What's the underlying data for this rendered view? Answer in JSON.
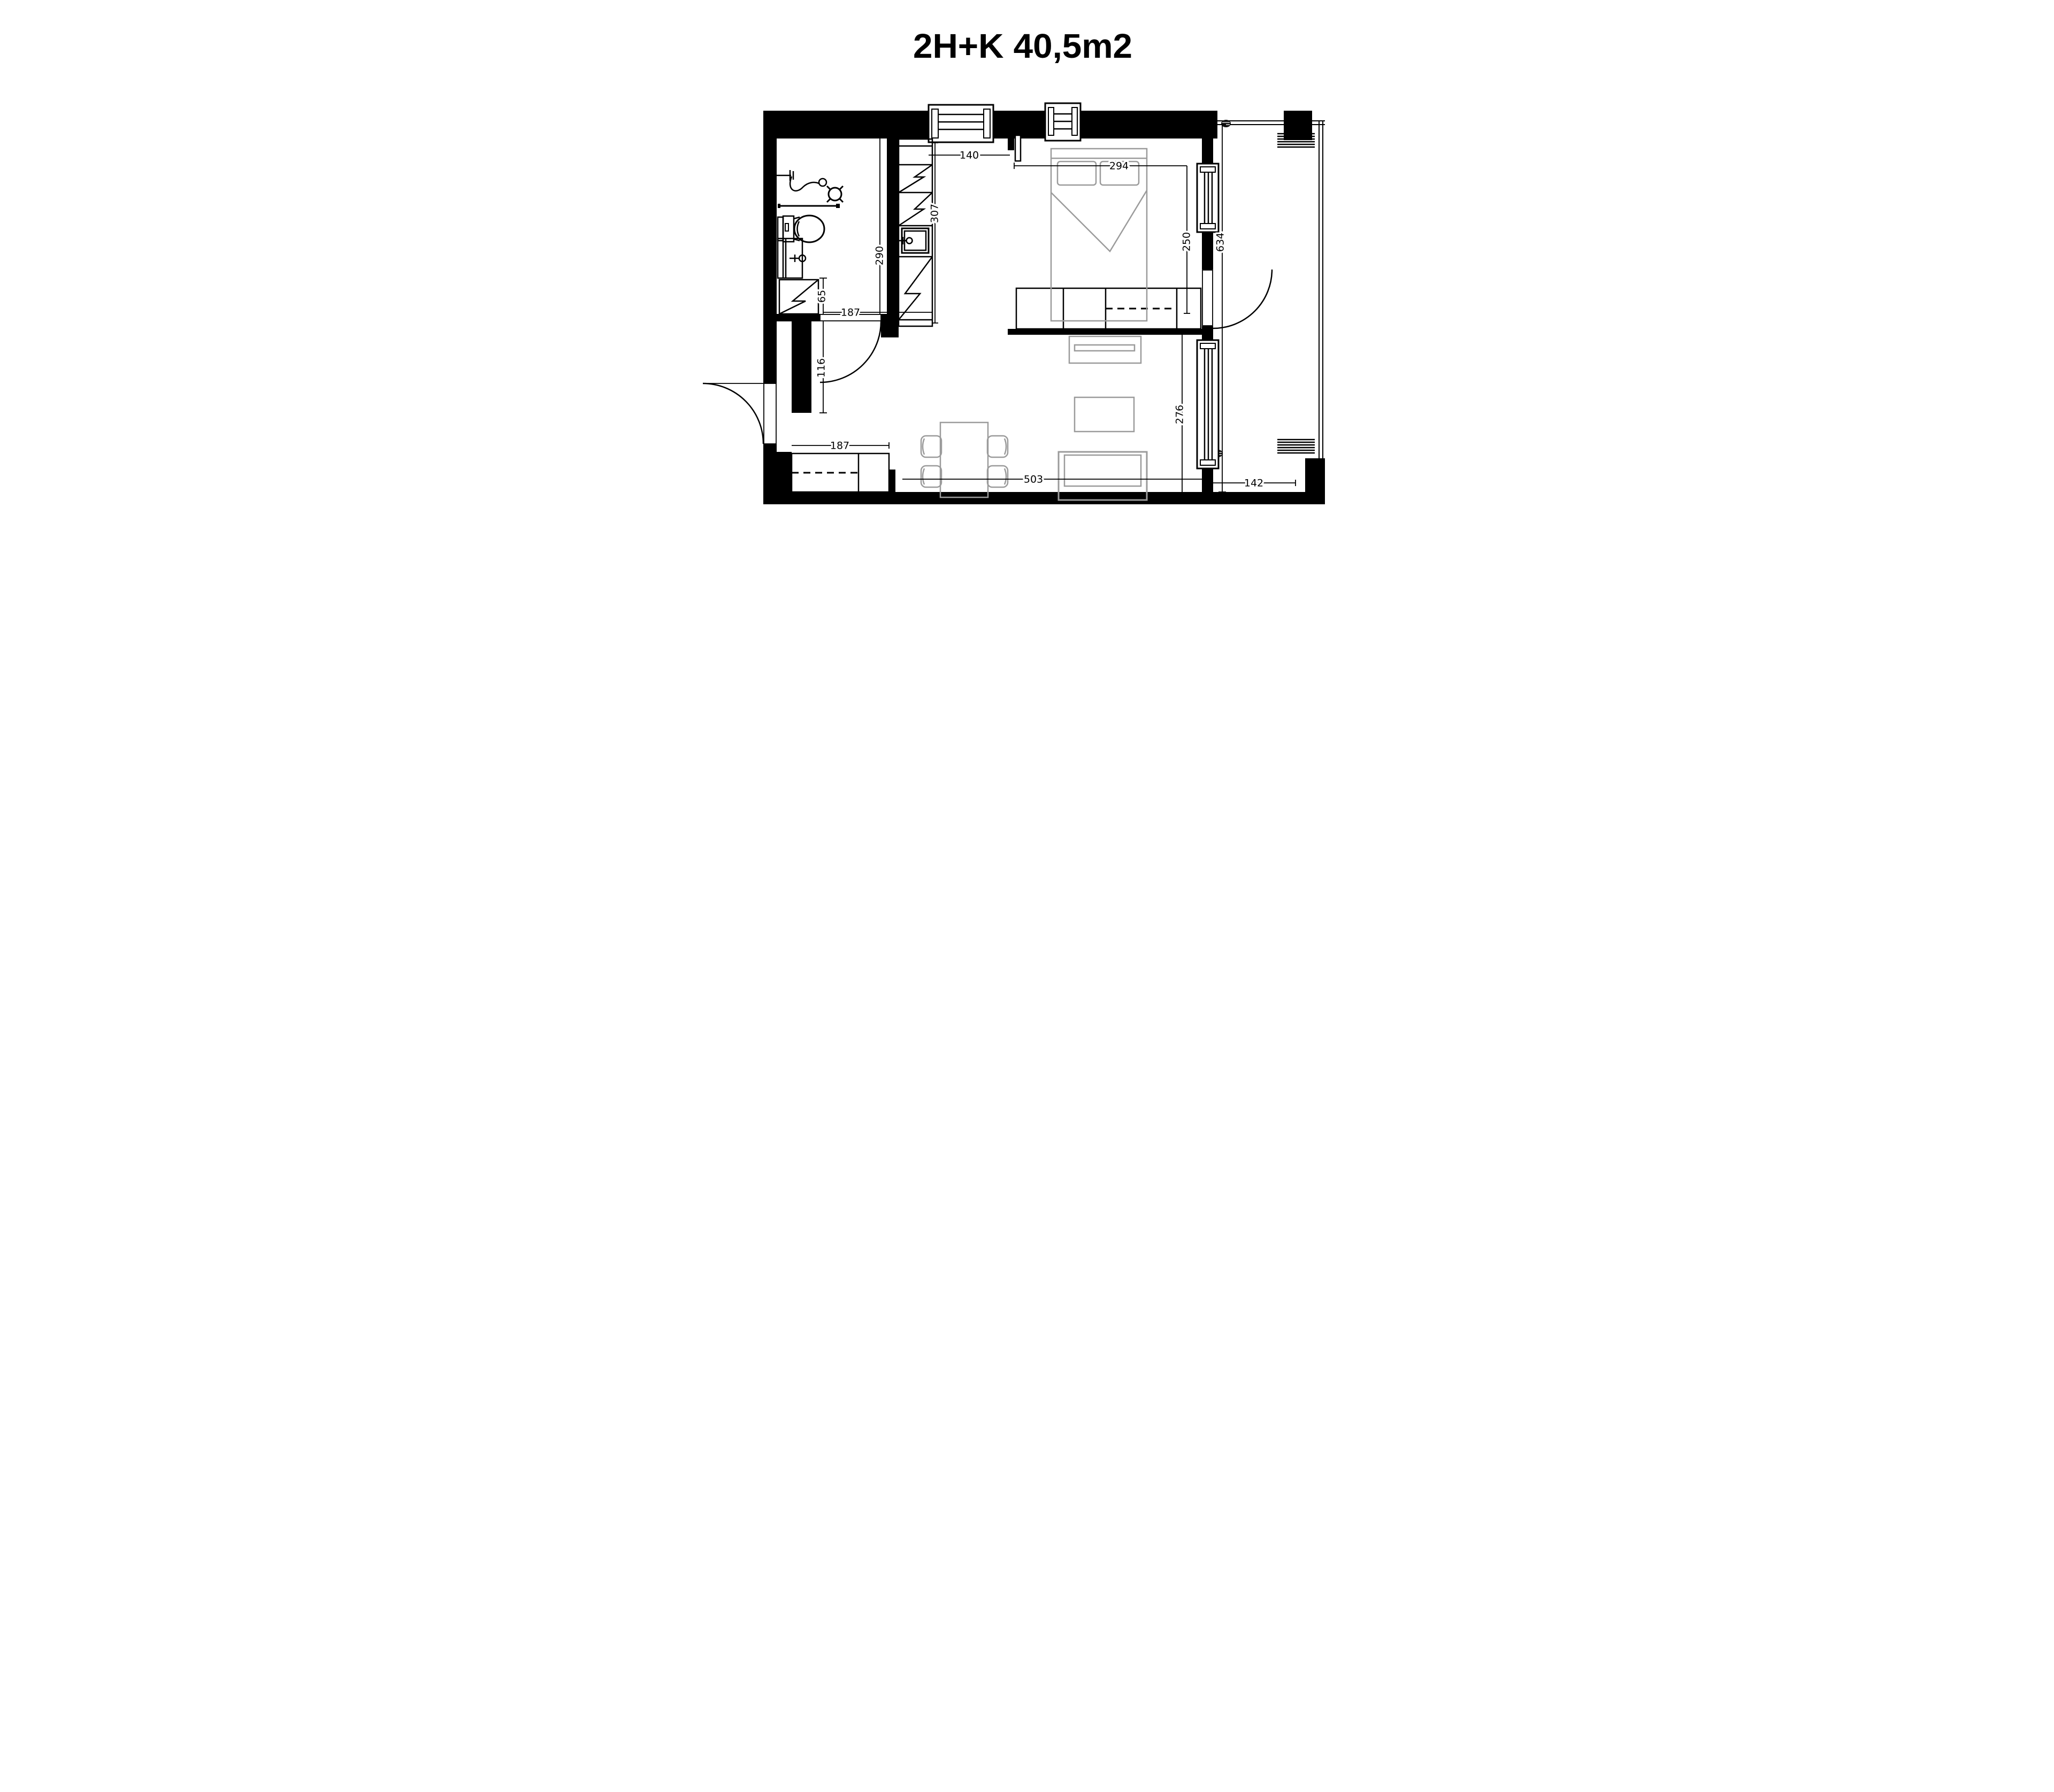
{
  "title": "2H+K 40,5m2",
  "plan_type": "apartment-floor-plan",
  "colors": {
    "walls": "#000000",
    "furniture_outline": "#9b9b9b",
    "background": "#ffffff"
  },
  "dimensions": {
    "kitchen_window_width": "140",
    "bedroom_width": "294",
    "bathroom_depth": "290",
    "kitchen_run_length": "307",
    "bedroom_depth": "250",
    "shower_clearance": "65",
    "bathroom_width": "187",
    "entry_wall_segment": "116",
    "hall_closet_width": "187",
    "living_room_width": "503",
    "living_room_depth": "276",
    "balcony_length": "634",
    "balcony_width": "142"
  },
  "fixtures": [
    "toilet",
    "washbasin-cabinet",
    "shower-enclosure",
    "shower-mixer",
    "shower-rail",
    "kitchen-cabinet-run",
    "kitchen-sink",
    "double-bed",
    "bedroom-wardrobe",
    "hall-closet",
    "tv-stand",
    "coffee-table",
    "sofa",
    "dining-table",
    "dining-chairs",
    "floor-drain",
    "ventilation-grille",
    "entrance-door",
    "bathroom-door",
    "balcony-door",
    "sliding-door",
    "windows"
  ]
}
